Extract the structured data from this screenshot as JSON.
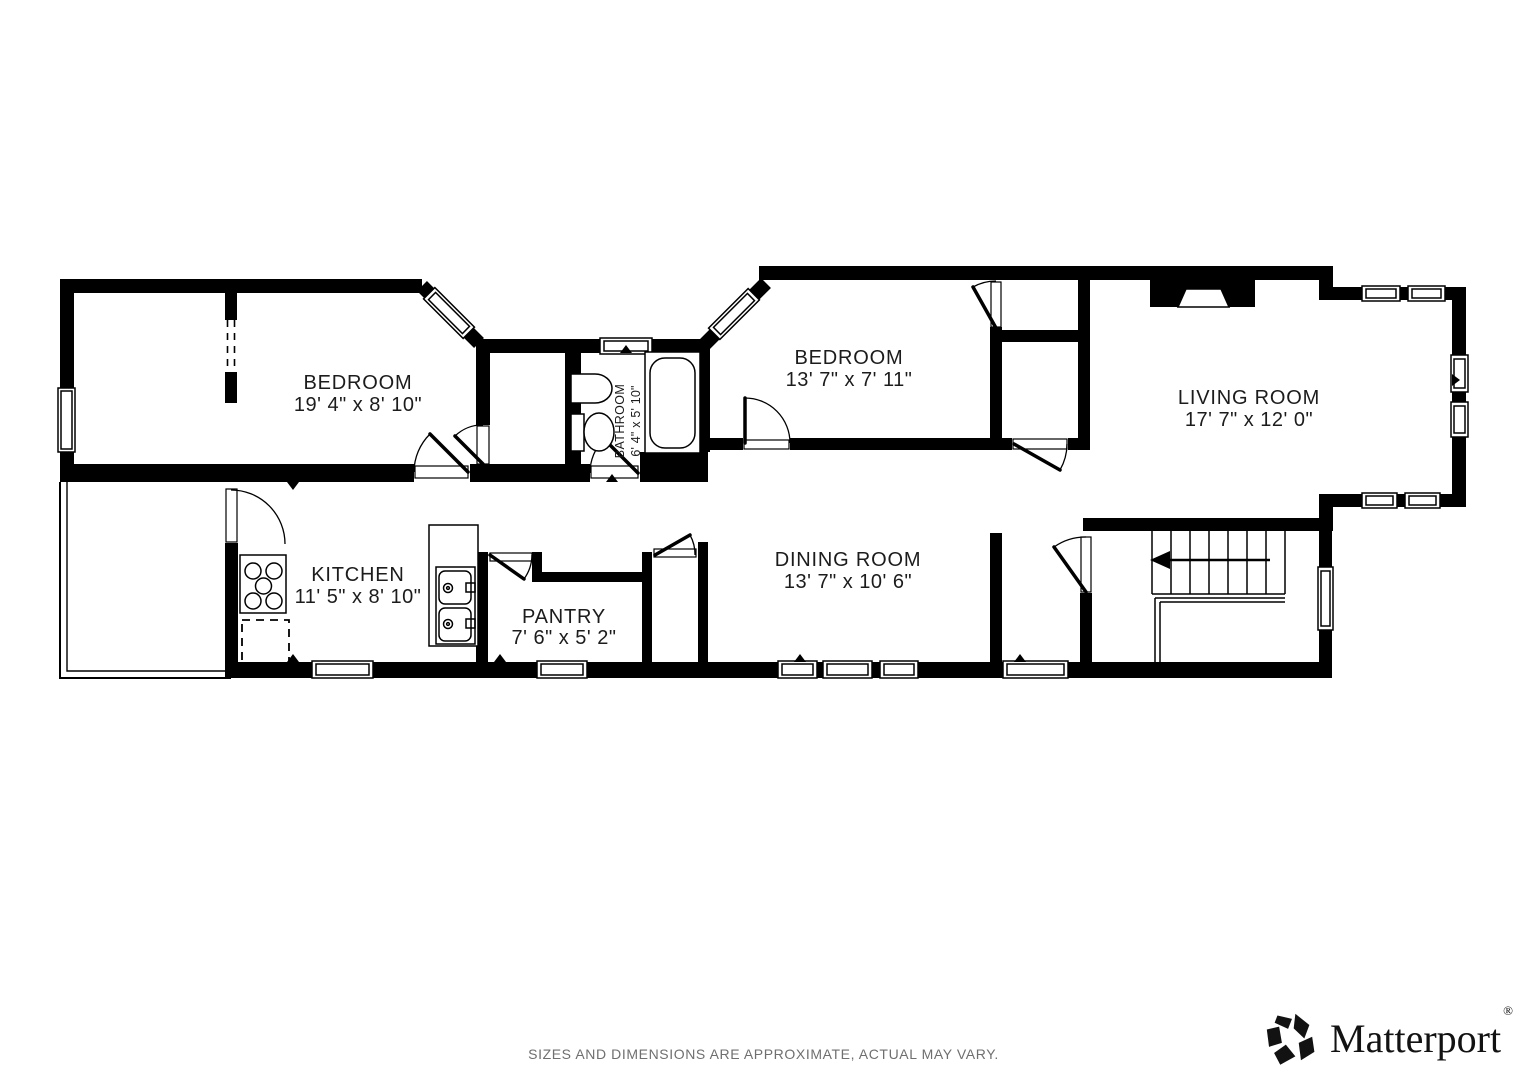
{
  "plan": {
    "rooms": [
      {
        "id": "bedroom-1",
        "name": "BEDROOM",
        "dims": "19' 4\" x 8' 10\""
      },
      {
        "id": "bathroom",
        "name": "BATHROOM",
        "dims": "6' 4\" x 5' 10\""
      },
      {
        "id": "bedroom-2",
        "name": "BEDROOM",
        "dims": "13' 7\" x 7' 11\""
      },
      {
        "id": "living-room",
        "name": "LIVING ROOM",
        "dims": "17' 7\" x 12' 0\""
      },
      {
        "id": "kitchen",
        "name": "KITCHEN",
        "dims": "11' 5\" x 8' 10\""
      },
      {
        "id": "pantry",
        "name": "PANTRY",
        "dims": "7' 6\" x 5' 2\""
      },
      {
        "id": "dining-room",
        "name": "DINING ROOM",
        "dims": "13' 7\" x 10' 6\""
      }
    ],
    "icons": [
      "stairs-down-arrow-icon",
      "fireplace-icon",
      "stove-icon",
      "kitchen-sink-icon",
      "bathroom-sink-icon",
      "toilet-icon",
      "bathtub-icon"
    ]
  },
  "footer": {
    "disclaimer": "SIZES AND DIMENSIONS ARE APPROXIMATE, ACTUAL MAY VARY."
  },
  "brand": {
    "name": "Matterport",
    "registered": "®",
    "icon": "matterport-logo-icon"
  },
  "colors": {
    "wall": "#000000",
    "background": "#ffffff",
    "label": "#1c1c1c",
    "muted": "#6f6f6f"
  }
}
